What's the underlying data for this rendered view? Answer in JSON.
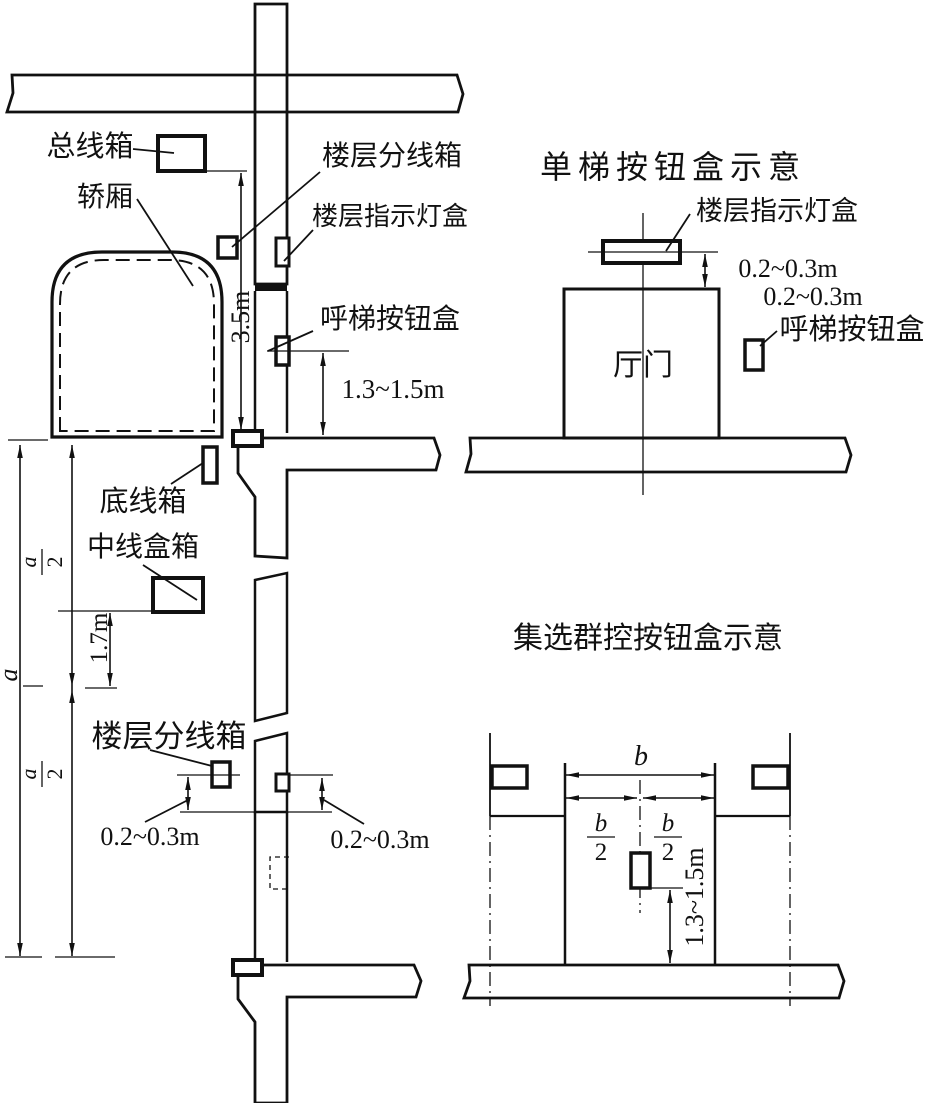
{
  "diagram": {
    "ink_color": "#111111",
    "background_color": "#ffffff",
    "left_section": {
      "labels": {
        "main_line_box": "总线箱",
        "car": "轿厢",
        "floor_branch_box": "楼层分线箱",
        "floor_indicator_box": "楼层指示灯盒",
        "call_button_box": "呼梯按钮盒",
        "bottom_line_box": "底线箱",
        "middle_line_box": "中线盒箱",
        "floor_branch_box_lower": "楼层分线箱"
      },
      "dimensions": {
        "top_to_car": "3.5m",
        "call_button_height": "1.3~1.5m",
        "middle_offset": "1.7m",
        "floor_height": "a",
        "half_numerator": "a",
        "half_denominator": "2",
        "branch_offset_left": "0.2~0.3m",
        "branch_offset_right": "0.2~0.3m"
      }
    },
    "single_elevator": {
      "title": "单梯按钮盒示意",
      "indicator_box_label": "楼层指示灯盒",
      "indicator_offset": "0.2~0.3m",
      "button_offset": "0.2~0.3m",
      "call_button_label": "呼梯按钮盒",
      "hall_door": "厅门"
    },
    "group_control": {
      "title": "集选群控按钮盒示意",
      "door_width": "b",
      "half_numerator": "b",
      "half_denominator": "2",
      "button_height": "1.3~1.5m"
    }
  }
}
